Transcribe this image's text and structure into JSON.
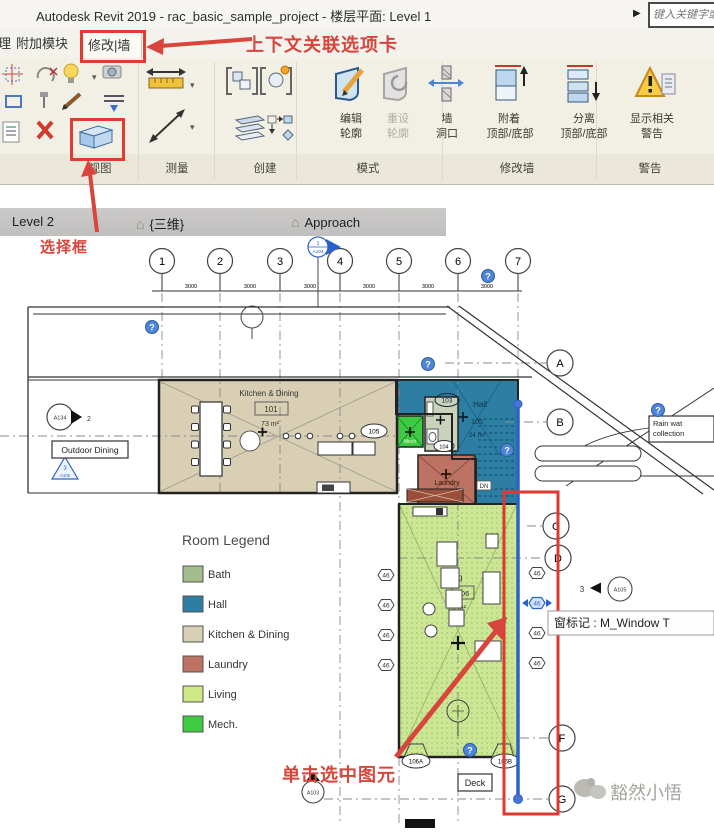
{
  "window": {
    "title": "Autodesk Revit 2019 - rac_basic_sample_project - 楼层平面: Level 1",
    "search_placeholder": "键入关键字或短"
  },
  "icons": {
    "caret": "▾",
    "play": "▶",
    "house": "⌂"
  },
  "tab_bar": {
    "partial": "理",
    "addins": "附加模块",
    "context": "修改|墙"
  },
  "annotations": {
    "context_note": "上下文关联选项卡",
    "selection_note": "选择框",
    "click_note": "单击选中图元"
  },
  "ribbon": {
    "buttons": {
      "edit_profile": [
        "编辑",
        "轮廓"
      ],
      "reset_profile": [
        "重设",
        "轮廓"
      ],
      "wall_opening": [
        "墙",
        "洞口"
      ],
      "attach": [
        "附着",
        "顶部/底部"
      ],
      "detach": [
        "分离",
        "顶部/底部"
      ],
      "show_warnings": [
        "显示相关",
        "警告"
      ]
    },
    "panels": {
      "view": "视图",
      "measure": "测量",
      "create": "创建",
      "mode": "模式",
      "modify_wall": "修改墙",
      "warning": "警告"
    }
  },
  "view_tabs": {
    "level2": "Level 2",
    "three_d": "{三维}",
    "approach": "Approach"
  },
  "plan": {
    "grid_numbers": [
      "1",
      "2",
      "3",
      "4",
      "5",
      "6",
      "7"
    ],
    "grid_letters": {
      "a": "A",
      "b": "B",
      "c": "C",
      "d": "D",
      "f": "F",
      "g": "G"
    },
    "dim": "3000",
    "rooms": {
      "kitchen": {
        "name": "Kitchen & Dining",
        "number": "101",
        "area": "73 m²"
      },
      "hall": {
        "name": "Hall",
        "number": "105",
        "area": "24 m²"
      },
      "living": {
        "name": "Living",
        "number": "106",
        "area": "70 m²"
      },
      "laundry": {
        "name": "Laundry"
      },
      "mech": {
        "name": "Mech"
      }
    },
    "tags": {
      "t103": "103",
      "t104": "104",
      "t105": "105",
      "t106a": "106A",
      "t106b": "106B",
      "window": "46"
    },
    "labels": {
      "outdoor_dining": "Outdoor Dining",
      "rain1": "Rain wat",
      "rain2": "collection",
      "deck": "Deck",
      "dn": "DN",
      "help": "?"
    },
    "markers": {
      "a104_num": "1",
      "a104": "A104",
      "a134": "A134",
      "a134_num": "2",
      "a105_num": "3",
      "a105": "A105",
      "a103": "A103"
    },
    "tooltip": "窗标记 : M_Window T",
    "legend": {
      "title": "Room Legend",
      "items": [
        {
          "label": "Bath",
          "color": "#a3bd8f"
        },
        {
          "label": "Hall",
          "color": "#2d7ea3"
        },
        {
          "label": "Kitchen & Dining",
          "color": "#d8cfb4"
        },
        {
          "label": "Laundry",
          "color": "#bd7363"
        },
        {
          "label": "Living",
          "color": "#cde884"
        },
        {
          "label": "Mech.",
          "color": "#3ecb41"
        }
      ]
    }
  },
  "watermark": "豁然小悟"
}
